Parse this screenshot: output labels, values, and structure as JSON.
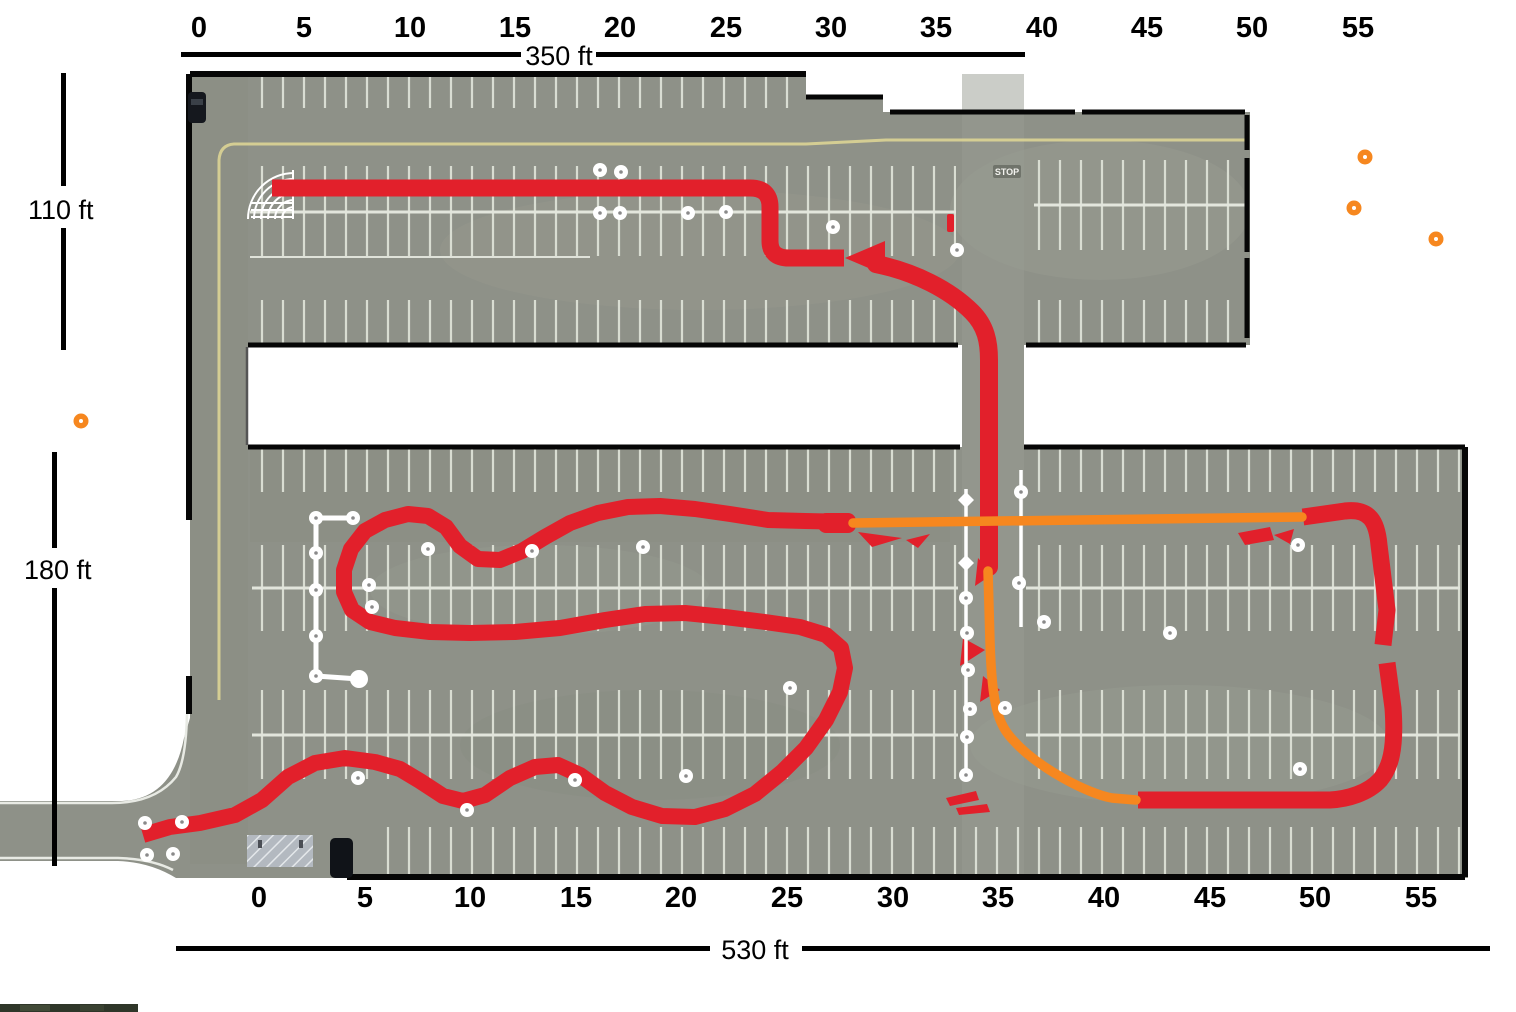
{
  "scales": {
    "top": {
      "ticks": [
        "0",
        "5",
        "10",
        "15",
        "20",
        "25",
        "30",
        "35",
        "40",
        "45",
        "50",
        "55"
      ],
      "length_label": "350 ft"
    },
    "bottom": {
      "ticks": [
        "0",
        "5",
        "10",
        "15",
        "20",
        "25",
        "30",
        "35",
        "40",
        "45",
        "50",
        "55"
      ],
      "length_label": "530 ft"
    },
    "left_upper_label": "110 ft",
    "left_lower_label": "180 ft"
  },
  "pavement": {
    "stop_marking": "STOP"
  },
  "colors": {
    "course_red": "#e2202b",
    "course_orange": "#f6871f",
    "cone_white": "#ffffff",
    "ruler_black": "#000000",
    "asphalt": "#8e9188"
  }
}
